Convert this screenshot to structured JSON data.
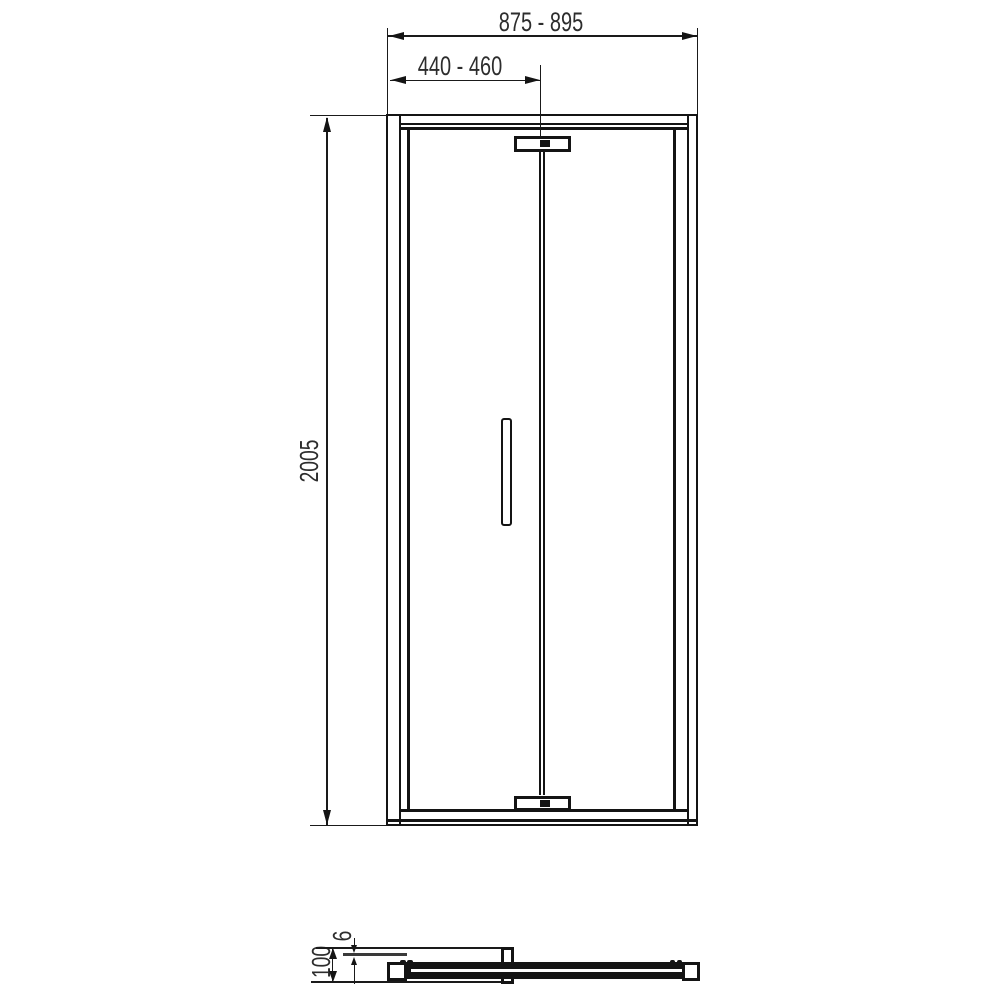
{
  "colors": {
    "background": "#ffffff",
    "line": "#141414",
    "text": "#2d2d2d"
  },
  "front_view": {
    "dims": {
      "overall_width": "875 - 895",
      "half_width": "440 - 460",
      "height": "2005"
    }
  },
  "section_view": {
    "dims": {
      "glass_thickness": "6",
      "total_depth": "100"
    }
  }
}
